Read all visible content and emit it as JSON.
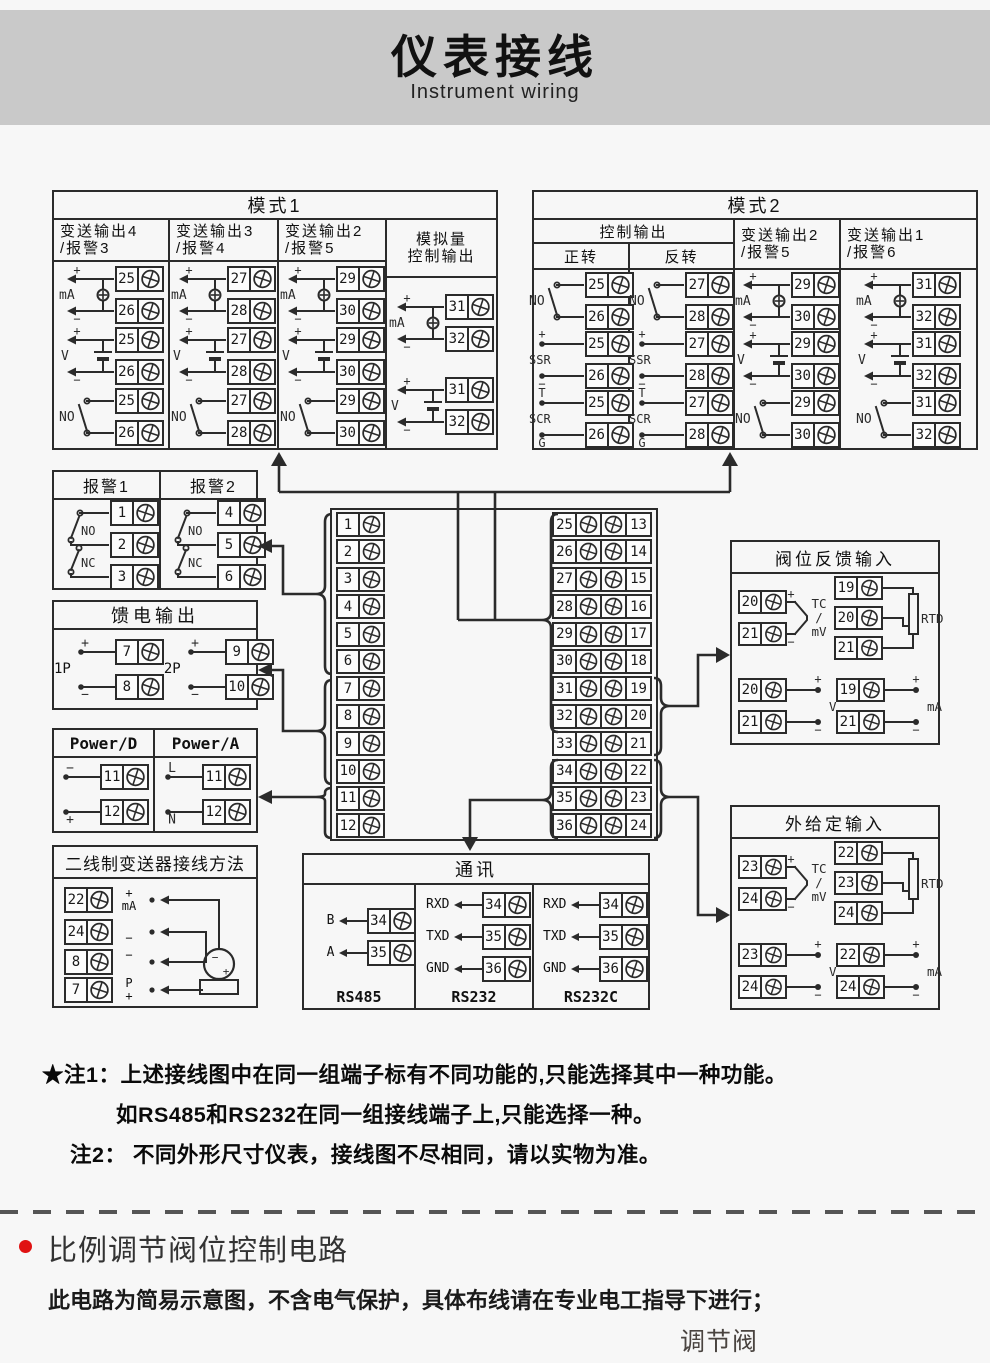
{
  "colors": {
    "line": "#2b2b2b",
    "banner": "#c9c9c9",
    "bg": "#f7f7f7",
    "red": "#e01212"
  },
  "banner": {
    "title": "仪表接线",
    "subtitle": "Instrument wiring"
  },
  "mode1": {
    "title": "模式1",
    "cols": [
      {
        "h1": "变送输出4",
        "h2": "/报警3",
        "d": [
          {
            "sym": "src",
            "label": "mA",
            "top": "+",
            "bottom": "−",
            "t": [
              "25",
              "26"
            ]
          },
          {
            "sym": "bat",
            "label": "V",
            "top": "+",
            "bottom": "−",
            "t": [
              "25",
              "26"
            ]
          },
          {
            "sym": "sw",
            "label": "NO",
            "t": [
              "25",
              "26"
            ]
          }
        ]
      },
      {
        "h1": "变送输出3",
        "h2": "/报警4",
        "d": [
          {
            "sym": "src",
            "label": "mA",
            "top": "+",
            "bottom": "−",
            "t": [
              "27",
              "28"
            ]
          },
          {
            "sym": "bat",
            "label": "V",
            "top": "+",
            "bottom": "−",
            "t": [
              "27",
              "28"
            ]
          },
          {
            "sym": "sw",
            "label": "NO",
            "t": [
              "27",
              "28"
            ]
          }
        ]
      },
      {
        "h1": "变送输出2",
        "h2": "/报警5",
        "d": [
          {
            "sym": "src",
            "label": "mA",
            "top": "+",
            "bottom": "−",
            "t": [
              "29",
              "30"
            ]
          },
          {
            "sym": "bat",
            "label": "V",
            "top": "+",
            "bottom": "−",
            "t": [
              "29",
              "30"
            ]
          },
          {
            "sym": "sw",
            "label": "NO",
            "t": [
              "29",
              "30"
            ]
          }
        ]
      },
      {
        "h1": "模拟量",
        "h2": "控制输出",
        "d": [
          {
            "sym": "src",
            "label": "mA",
            "top": "+",
            "bottom": "−",
            "t": [
              "31",
              "32"
            ]
          },
          {
            "sym": "bat",
            "label": "V",
            "top": "+",
            "bottom": "−",
            "t": [
              "31",
              "32"
            ]
          }
        ]
      }
    ]
  },
  "mode2": {
    "title": "模式2",
    "group_header": "控制输出",
    "sub1": "正转",
    "sub2": "反转",
    "col3": {
      "h1": "变送输出2",
      "h2": "/报警5"
    },
    "col4": {
      "h1": "变送输出1",
      "h2": "/报警6"
    },
    "d1": [
      {
        "sym": "sw",
        "label": "NO",
        "t": [
          "25",
          "26"
        ]
      },
      {
        "sym": "plain",
        "label": "SSR",
        "top": "+",
        "bottom": "−",
        "t": [
          "25",
          "26"
        ]
      },
      {
        "sym": "plain",
        "label": "SCR",
        "top": "T",
        "bottom": "G",
        "t": [
          "25",
          "26"
        ]
      }
    ],
    "d2": [
      {
        "sym": "sw",
        "label": "NO",
        "t": [
          "27",
          "28"
        ]
      },
      {
        "sym": "plain",
        "label": "SSR",
        "top": "+",
        "bottom": "−",
        "t": [
          "27",
          "28"
        ]
      },
      {
        "sym": "plain",
        "label": "SCR",
        "top": "T",
        "bottom": "G",
        "t": [
          "27",
          "28"
        ]
      }
    ],
    "d3": [
      {
        "sym": "src",
        "label": "mA",
        "top": "+",
        "bottom": "−",
        "t": [
          "29",
          "30"
        ]
      },
      {
        "sym": "bat",
        "label": "V",
        "top": "+",
        "bottom": "−",
        "t": [
          "29",
          "30"
        ]
      },
      {
        "sym": "sw",
        "label": "NO",
        "t": [
          "29",
          "30"
        ]
      }
    ],
    "d4": [
      {
        "sym": "src",
        "label": "mA",
        "top": "+",
        "bottom": "−",
        "t": [
          "31",
          "32"
        ]
      },
      {
        "sym": "bat",
        "label": "V",
        "top": "+",
        "bottom": "−",
        "t": [
          "31",
          "32"
        ]
      },
      {
        "sym": "sw",
        "label": "NO",
        "t": [
          "31",
          "32"
        ]
      }
    ]
  },
  "alarm": {
    "cols": [
      {
        "title": "报警1",
        "no": "NO",
        "nc": "NC",
        "t": [
          "1",
          "2",
          "3"
        ]
      },
      {
        "title": "报警2",
        "no": "NO",
        "nc": "NC",
        "t": [
          "4",
          "5",
          "6"
        ]
      }
    ]
  },
  "feed": {
    "title": "馈电输出",
    "d": [
      {
        "pre": "1P",
        "top": "+",
        "bottom": "−",
        "t": [
          "7",
          "8"
        ]
      },
      {
        "pre": "2P",
        "top": "+",
        "bottom": "−",
        "t": [
          "9",
          "10"
        ]
      }
    ]
  },
  "power": {
    "cols": [
      {
        "title": "Power/D",
        "top": "−",
        "bottom": "+",
        "t": [
          "11",
          "12"
        ]
      },
      {
        "title": "Power/A",
        "top": "L",
        "bottom": "N",
        "t": [
          "11",
          "12"
        ]
      }
    ]
  },
  "twowire": {
    "title": "二线制变送器接线方法",
    "rows": [
      {
        "t": "22",
        "l1": "+",
        "l2": "mA"
      },
      {
        "t": "24",
        "l1": "",
        "l2": "−"
      },
      {
        "t": "8",
        "l1": "−",
        "l2": ""
      },
      {
        "t": "7",
        "l1": "P",
        "l2": "+"
      }
    ],
    "tx_minus": "−",
    "tx_plus": "+"
  },
  "comm": {
    "title": "通讯",
    "groups": [
      {
        "name": "RS485",
        "rows": [
          {
            "l": "B",
            "t": "34"
          },
          {
            "l": "A",
            "t": "35"
          }
        ]
      },
      {
        "name": "RS232",
        "rows": [
          {
            "l": "RXD",
            "t": "34"
          },
          {
            "l": "TXD",
            "t": "35"
          },
          {
            "l": "GND",
            "t": "36"
          }
        ]
      },
      {
        "name": "RS232C",
        "rows": [
          {
            "l": "RXD",
            "t": "34"
          },
          {
            "l": "TXD",
            "t": "35"
          },
          {
            "l": "GND",
            "t": "36"
          }
        ]
      }
    ]
  },
  "valve_fb": {
    "title": "阀位反馈输入",
    "tc": {
      "t": [
        "20",
        "21"
      ],
      "top": "+",
      "bottom": "−",
      "lines": [
        "TC",
        "/",
        "mV"
      ]
    },
    "rtd": {
      "t": [
        "19",
        "20",
        "21"
      ],
      "label": "RTD"
    },
    "v": {
      "t": [
        "20",
        "21"
      ],
      "top": "+",
      "bottom": "−",
      "label": "V"
    },
    "ma": {
      "t": [
        "19",
        "21"
      ],
      "top": "+",
      "bottom": "−",
      "label": "mA"
    }
  },
  "ext_sp": {
    "title": "外给定输入",
    "tc": {
      "t": [
        "23",
        "24"
      ],
      "top": "+",
      "bottom": "−",
      "lines": [
        "TC",
        "/",
        "mV"
      ]
    },
    "rtd": {
      "t": [
        "22",
        "23",
        "24"
      ],
      "label": "RTD"
    },
    "v": {
      "t": [
        "23",
        "24"
      ],
      "top": "+",
      "bottom": "−",
      "label": "V"
    },
    "ma": {
      "t": [
        "22",
        "24"
      ],
      "top": "+",
      "bottom": "−",
      "label": "mA"
    }
  },
  "block": {
    "left": [
      "1",
      "2",
      "3",
      "4",
      "5",
      "6",
      "7",
      "8",
      "9",
      "10",
      "11",
      "12"
    ],
    "mid": [
      "25",
      "26",
      "27",
      "28",
      "29",
      "30",
      "31",
      "32",
      "33",
      "34",
      "35",
      "36"
    ],
    "right": [
      "13",
      "14",
      "15",
      "16",
      "17",
      "18",
      "19",
      "20",
      "21",
      "22",
      "23",
      "24"
    ]
  },
  "notes": {
    "n1": "★注1：上述接线图中在同一组端子标有不同功能的,只能选择其中一种功能。",
    "n2": "如RS485和RS232在同一组接线端子上,只能选择一种。",
    "n3": "注2： 不同外形尺寸仪表，接线图不尽相同，请以实物为准。"
  },
  "bottom": {
    "heading": "比例调节阀位控制电路",
    "desc": "此电路为简易示意图，不含电气保护，具体布线请在专业电工指导下进行；",
    "valve": "调节阀"
  }
}
